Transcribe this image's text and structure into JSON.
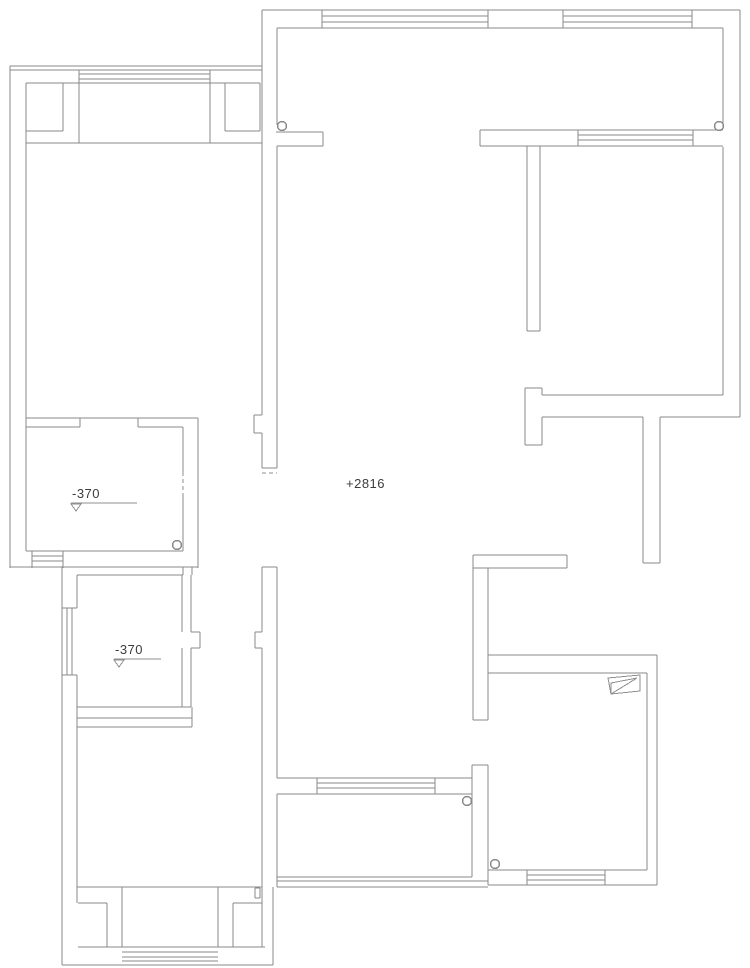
{
  "title": "apartment-floor-plan",
  "canvas": {
    "width": 750,
    "height": 968,
    "background": "#ffffff",
    "wall_color": "#8a8a8a",
    "annot_color": "#8f8f8f",
    "text_color": "#3c3c3c"
  },
  "labels": [
    {
      "name": "level-annotation-upper-bath",
      "text": "-370",
      "x": 72,
      "y": 487
    },
    {
      "name": "level-annotation-lower-bath",
      "text": "-370",
      "x": 115,
      "y": 643
    },
    {
      "name": "height-annotation-living",
      "text": "+2816",
      "x": 346,
      "y": 477
    }
  ],
  "plan": {
    "segments": [
      [
        10,
        66,
        262,
        66
      ],
      [
        10,
        70,
        262,
        70
      ],
      [
        79,
        74,
        210,
        74
      ],
      [
        79,
        79,
        210,
        79
      ],
      [
        79,
        70,
        79,
        143
      ],
      [
        210,
        70,
        210,
        143
      ],
      [
        26,
        83,
        260,
        83
      ],
      [
        10,
        66,
        10,
        568
      ],
      [
        26,
        83,
        26,
        551
      ],
      [
        63,
        83,
        63,
        131
      ],
      [
        26,
        131,
        63,
        131
      ],
      [
        225,
        83,
        225,
        131
      ],
      [
        225,
        131,
        260,
        131
      ],
      [
        260,
        83,
        260,
        131
      ],
      [
        26,
        143,
        262,
        143
      ],
      [
        262,
        10,
        262,
        415
      ],
      [
        262,
        433,
        262,
        468
      ],
      [
        277,
        146,
        277,
        468
      ],
      [
        254,
        415,
        262,
        415
      ],
      [
        254,
        415,
        254,
        433
      ],
      [
        254,
        433,
        262,
        433
      ],
      [
        262,
        468,
        277,
        468
      ],
      [
        262,
        567,
        262,
        632
      ],
      [
        262,
        648,
        262,
        887
      ],
      [
        277,
        567,
        277,
        778
      ],
      [
        277,
        794,
        277,
        887
      ],
      [
        262,
        567,
        277,
        567
      ],
      [
        255,
        632,
        262,
        632
      ],
      [
        255,
        632,
        255,
        648
      ],
      [
        255,
        648,
        262,
        648
      ],
      [
        276,
        132,
        323,
        132
      ],
      [
        277,
        146,
        323,
        146
      ],
      [
        323,
        132,
        323,
        146
      ],
      [
        277,
        28,
        277,
        125
      ],
      [
        262,
        10,
        740,
        10
      ],
      [
        277,
        28,
        723,
        28
      ],
      [
        322,
        16,
        488,
        16
      ],
      [
        322,
        22,
        488,
        22
      ],
      [
        563,
        16,
        692,
        16
      ],
      [
        563,
        22,
        692,
        22
      ],
      [
        322,
        10,
        322,
        28
      ],
      [
        488,
        10,
        488,
        28
      ],
      [
        563,
        10,
        563,
        28
      ],
      [
        692,
        10,
        692,
        28
      ],
      [
        740,
        10,
        740,
        417
      ],
      [
        723,
        28,
        723,
        128
      ],
      [
        723,
        147,
        723,
        395
      ],
      [
        480,
        130,
        723,
        130
      ],
      [
        480,
        146,
        723,
        146
      ],
      [
        480,
        130,
        480,
        146
      ],
      [
        578,
        135,
        693,
        135
      ],
      [
        578,
        140,
        693,
        140
      ],
      [
        578,
        130,
        578,
        146
      ],
      [
        693,
        130,
        693,
        146
      ],
      [
        527,
        146,
        527,
        331
      ],
      [
        540,
        146,
        540,
        331
      ],
      [
        527,
        331,
        540,
        331
      ],
      [
        525,
        388,
        542,
        388
      ],
      [
        525,
        388,
        525,
        445
      ],
      [
        525,
        445,
        542,
        445
      ],
      [
        542,
        388,
        542,
        395
      ],
      [
        542,
        417,
        542,
        445
      ],
      [
        542,
        395,
        723,
        395
      ],
      [
        542,
        417,
        643,
        417
      ],
      [
        660,
        417,
        740,
        417
      ],
      [
        643,
        417,
        643,
        563
      ],
      [
        660,
        417,
        660,
        563
      ],
      [
        643,
        563,
        660,
        563
      ],
      [
        473,
        555,
        567,
        555
      ],
      [
        473,
        568,
        567,
        568
      ],
      [
        473,
        555,
        473,
        568
      ],
      [
        567,
        555,
        567,
        568
      ],
      [
        473,
        568,
        473,
        720
      ],
      [
        488,
        568,
        488,
        720
      ],
      [
        473,
        720,
        488,
        720
      ],
      [
        472,
        765,
        488,
        765
      ],
      [
        472,
        765,
        472,
        877
      ],
      [
        488,
        765,
        488,
        885
      ],
      [
        488,
        655,
        657,
        655
      ],
      [
        488,
        673,
        647,
        673
      ],
      [
        657,
        655,
        657,
        885
      ],
      [
        647,
        673,
        647,
        870
      ],
      [
        488,
        885,
        657,
        885
      ],
      [
        488,
        870,
        647,
        870
      ],
      [
        527,
        875,
        605,
        875
      ],
      [
        527,
        880,
        605,
        880
      ],
      [
        527,
        870,
        527,
        885
      ],
      [
        605,
        870,
        605,
        885
      ],
      [
        277,
        778,
        472,
        778
      ],
      [
        277,
        794,
        472,
        794
      ],
      [
        317,
        783,
        435,
        783
      ],
      [
        317,
        788,
        435,
        788
      ],
      [
        317,
        778,
        317,
        794
      ],
      [
        435,
        778,
        435,
        794
      ],
      [
        277,
        877,
        472,
        877
      ],
      [
        277,
        881,
        488,
        881
      ],
      [
        277,
        887,
        488,
        887
      ],
      [
        255,
        888,
        260,
        888
      ],
      [
        260,
        888,
        260,
        898
      ],
      [
        255,
        898,
        260,
        898
      ],
      [
        255,
        888,
        255,
        898
      ],
      [
        26,
        418,
        198,
        418
      ],
      [
        26,
        427,
        80,
        427
      ],
      [
        138,
        427,
        183,
        427
      ],
      [
        80,
        418,
        80,
        427
      ],
      [
        138,
        418,
        138,
        427
      ],
      [
        183,
        427,
        183,
        438
      ],
      [
        198,
        418,
        198,
        568
      ],
      [
        183,
        438,
        183,
        472
      ],
      [
        183,
        495,
        183,
        551
      ],
      [
        26,
        551,
        183,
        551
      ],
      [
        32,
        551,
        32,
        568
      ],
      [
        63,
        551,
        63,
        568
      ],
      [
        32,
        556,
        63,
        556
      ],
      [
        32,
        561,
        63,
        561
      ],
      [
        10,
        567,
        198,
        567
      ],
      [
        77,
        575,
        183,
        575
      ],
      [
        183,
        567,
        183,
        575
      ],
      [
        192,
        567,
        192,
        575
      ],
      [
        182,
        575,
        182,
        632
      ],
      [
        182,
        648,
        182,
        707
      ],
      [
        191,
        575,
        191,
        632
      ],
      [
        191,
        648,
        191,
        707
      ],
      [
        191,
        632,
        200,
        632
      ],
      [
        200,
        632,
        200,
        648
      ],
      [
        191,
        648,
        200,
        648
      ],
      [
        77,
        707,
        191,
        707
      ],
      [
        77,
        718,
        192,
        718
      ],
      [
        62,
        567,
        62,
        965
      ],
      [
        77,
        575,
        77,
        608
      ],
      [
        77,
        675,
        77,
        903
      ],
      [
        62,
        608,
        77,
        608
      ],
      [
        62,
        675,
        77,
        675
      ],
      [
        67,
        608,
        67,
        675
      ],
      [
        72,
        608,
        72,
        675
      ],
      [
        192,
        707,
        192,
        727
      ],
      [
        77,
        727,
        192,
        727
      ],
      [
        77,
        887,
        262,
        887
      ],
      [
        122,
        887,
        122,
        947
      ],
      [
        218,
        887,
        218,
        947
      ],
      [
        78,
        903,
        107,
        903
      ],
      [
        107,
        903,
        107,
        947
      ],
      [
        233,
        903,
        262,
        903
      ],
      [
        233,
        903,
        233,
        947
      ],
      [
        262,
        887,
        262,
        947
      ],
      [
        78,
        947,
        265,
        947
      ],
      [
        122,
        952,
        218,
        952
      ],
      [
        122,
        957,
        218,
        957
      ],
      [
        122,
        961,
        218,
        961
      ],
      [
        62,
        965,
        273,
        965
      ],
      [
        273,
        887,
        273,
        965
      ]
    ],
    "dashed_segments": [
      [
        183,
        472,
        183,
        495
      ],
      [
        262,
        473,
        277,
        473
      ]
    ],
    "annot_segments": [
      [
        71,
        503,
        137,
        503
      ],
      [
        114,
        659,
        161,
        659
      ]
    ],
    "circles": [
      [
        282,
        126
      ],
      [
        719,
        126
      ],
      [
        177,
        545
      ],
      [
        467,
        801
      ],
      [
        495,
        864
      ]
    ],
    "circle_radius": 4.5,
    "polygons": [
      {
        "name": "appliance-symbol",
        "points": "608,678 640,675 640,691 611,694"
      },
      {
        "name": "appliance-symbol-fold",
        "points": "611,683 637,678 611,694"
      },
      {
        "name": "level-triangle-icon",
        "points": "71,504 81,504 76,511"
      },
      {
        "name": "level-triangle-icon",
        "points": "114,660 124,660 119,667"
      }
    ]
  }
}
